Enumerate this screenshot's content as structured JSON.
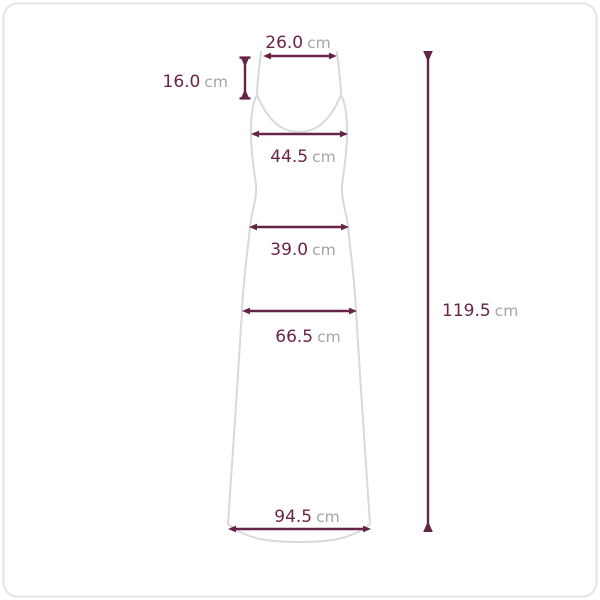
{
  "diagram_type": "garment-size-measurement",
  "unit_label": "cm",
  "measurements": {
    "top_width": {
      "value": "26.0",
      "unit": "cm"
    },
    "strap_length": {
      "value": "16.0",
      "unit": "cm"
    },
    "bust_width": {
      "value": "44.5",
      "unit": "cm"
    },
    "waist_width": {
      "value": "39.0",
      "unit": "cm"
    },
    "hip_width": {
      "value": "66.5",
      "unit": "cm"
    },
    "hem_width": {
      "value": "94.5",
      "unit": "cm"
    },
    "total_length": {
      "value": "119.5",
      "unit": "cm"
    }
  },
  "colors": {
    "dimension_accent": "#662348",
    "value_text": "#6D2349",
    "unit_text": "#A5A5A5",
    "garment_outline": "#D9D9D9",
    "card_border": "#E1E1E1",
    "background": "#FFFFFF"
  }
}
